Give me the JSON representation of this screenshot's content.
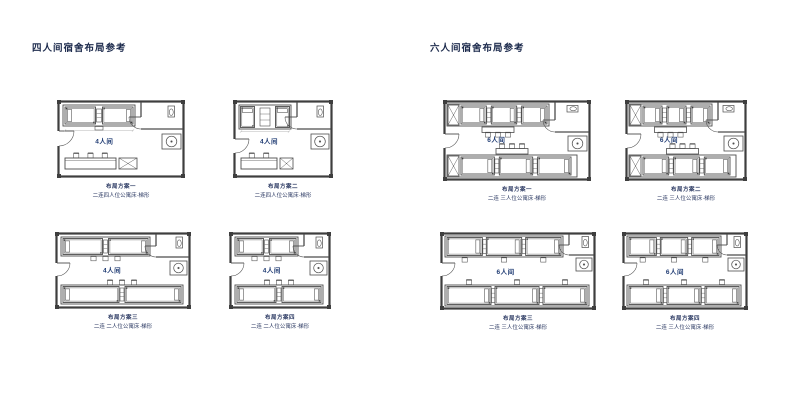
{
  "page": {
    "background": "#ffffff"
  },
  "colors": {
    "wall": "#3e3e3e",
    "line": "#4c4c4c",
    "dim": "#9a9a9a",
    "title": "#1d2b4d",
    "caption": "#2c3a63",
    "room_label": "#1f3b73"
  },
  "sections": [
    {
      "id": "four-person",
      "title": "四人间宿舍布局参考",
      "plans": [
        {
          "room_label": "4人间",
          "caption1": "布局方案一",
          "caption2": "二连四人位公寓床·梯形",
          "variant": "dorm4a",
          "x": 57,
          "y": 100,
          "w": 128,
          "h": 78
        },
        {
          "room_label": "4人间",
          "caption1": "布局方案二",
          "caption2": "二连四人位公寓床·梯形",
          "variant": "dorm4b",
          "x": 233,
          "y": 100,
          "w": 100,
          "h": 78
        },
        {
          "room_label": "4人间",
          "caption1": "布局方案三",
          "caption2": "二连 二人位公寓床·梯形",
          "variant": "dorm4c",
          "x": 55,
          "y": 232,
          "w": 136,
          "h": 77
        },
        {
          "room_label": "4人间",
          "caption1": "布局方案四",
          "caption2": "二连 二人位公寓床·梯形",
          "variant": "dorm4c",
          "x": 229,
          "y": 232,
          "w": 102,
          "h": 77
        }
      ]
    },
    {
      "id": "six-person",
      "title": "六人间宿舍布局参考",
      "plans": [
        {
          "room_label": "6人间",
          "caption1": "布局方案一",
          "caption2": "二连 三人位公寓床·梯形",
          "variant": "dorm6a",
          "x": 443,
          "y": 100,
          "w": 148,
          "h": 81
        },
        {
          "room_label": "6人间",
          "caption1": "布局方案二",
          "caption2": "二连 三人位公寓床·梯形",
          "variant": "dorm6a",
          "x": 625,
          "y": 100,
          "w": 122,
          "h": 81
        },
        {
          "room_label": "6人间",
          "caption1": "布局方案三",
          "caption2": "二连 三人位公寓床·梯形",
          "variant": "dorm6b",
          "x": 440,
          "y": 232,
          "w": 156,
          "h": 78
        },
        {
          "room_label": "6人间",
          "caption1": "布局方案四",
          "caption2": "二连 三人位公寓床·梯形",
          "variant": "dorm6b",
          "x": 622,
          "y": 232,
          "w": 126,
          "h": 78
        }
      ]
    }
  ]
}
